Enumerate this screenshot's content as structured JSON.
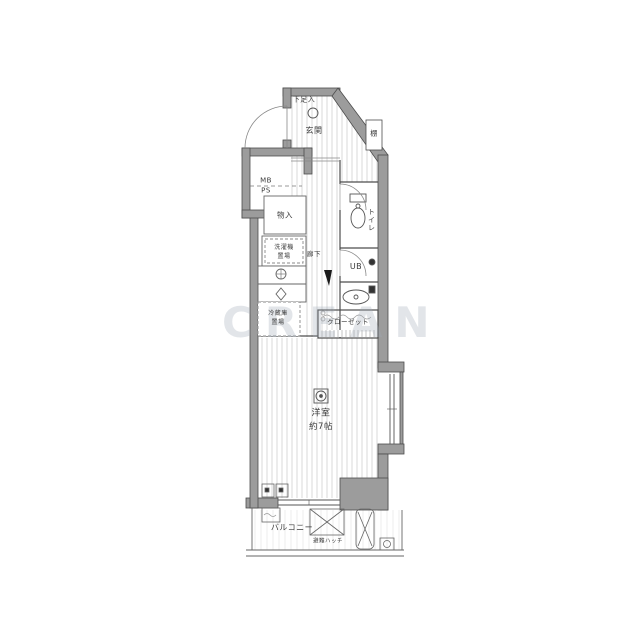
{
  "watermark": "CREAN",
  "labels": {
    "shoe_box": "下足入",
    "entrance": "玄関",
    "shelf": "棚",
    "mb": "MB",
    "ps": "PS",
    "storage": "物入",
    "toilet": "トイレ",
    "hall": "廊下",
    "washer_l1": "洗濯機",
    "washer_l2": "置場",
    "bath": "UB",
    "closet": "クローゼット",
    "fridge_l1": "冷蔵庫",
    "fridge_l2": "置場",
    "room": "洋室",
    "room_size": "約7帖",
    "balcony": "バルコニー",
    "hatch": "避難ハッチ"
  }
}
